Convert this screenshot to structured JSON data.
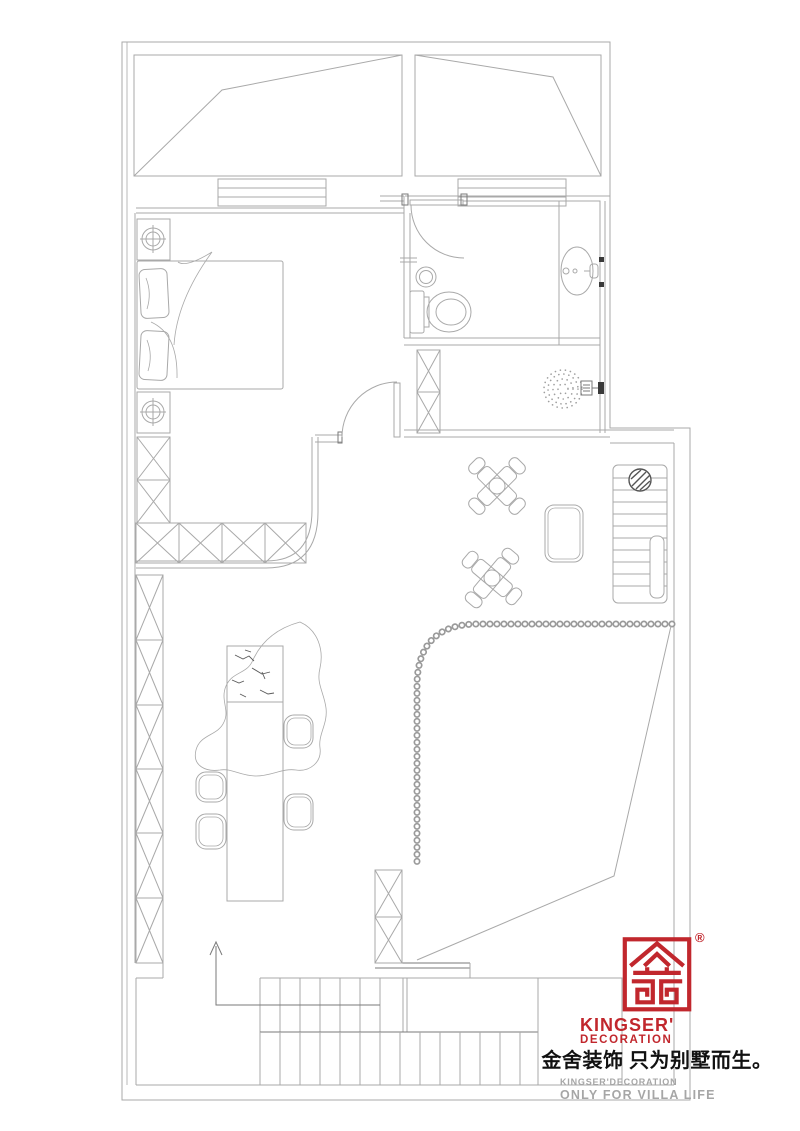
{
  "page": {
    "background": "#ffffff"
  },
  "floor_plan": {
    "type": "residential-floor-plan-line-drawing",
    "line_color": "#a9a9a9",
    "accent_line_color": "#7a7a7a",
    "symbols": [
      "roof-slope",
      "window",
      "door-swing",
      "double-bed",
      "pillow",
      "nightstand-with-lamp",
      "wardrobe-lattice",
      "toilet",
      "floor-drain",
      "vanity-sink",
      "shower-spray",
      "shower-head",
      "staircase-up",
      "structural-column",
      "tea-table-with-chairs",
      "ottoman",
      "bead-screen-curve",
      "stone-bar-island",
      "bar-stool",
      "stair-direction-arrow"
    ]
  },
  "branding": {
    "registered_mark": "®",
    "logo_name": "KINGSER'",
    "logo_subtitle": "DECORATION",
    "slogan_cn": "金舍装饰 只为别墅而生。",
    "watermark_line1": "KINGSER'DECORATION",
    "watermark_line2": "ONLY FOR VILLA LIFE",
    "brand_red": "#c1272d",
    "text_black": "#111111",
    "watermark_gray": "#a6a6a6"
  }
}
